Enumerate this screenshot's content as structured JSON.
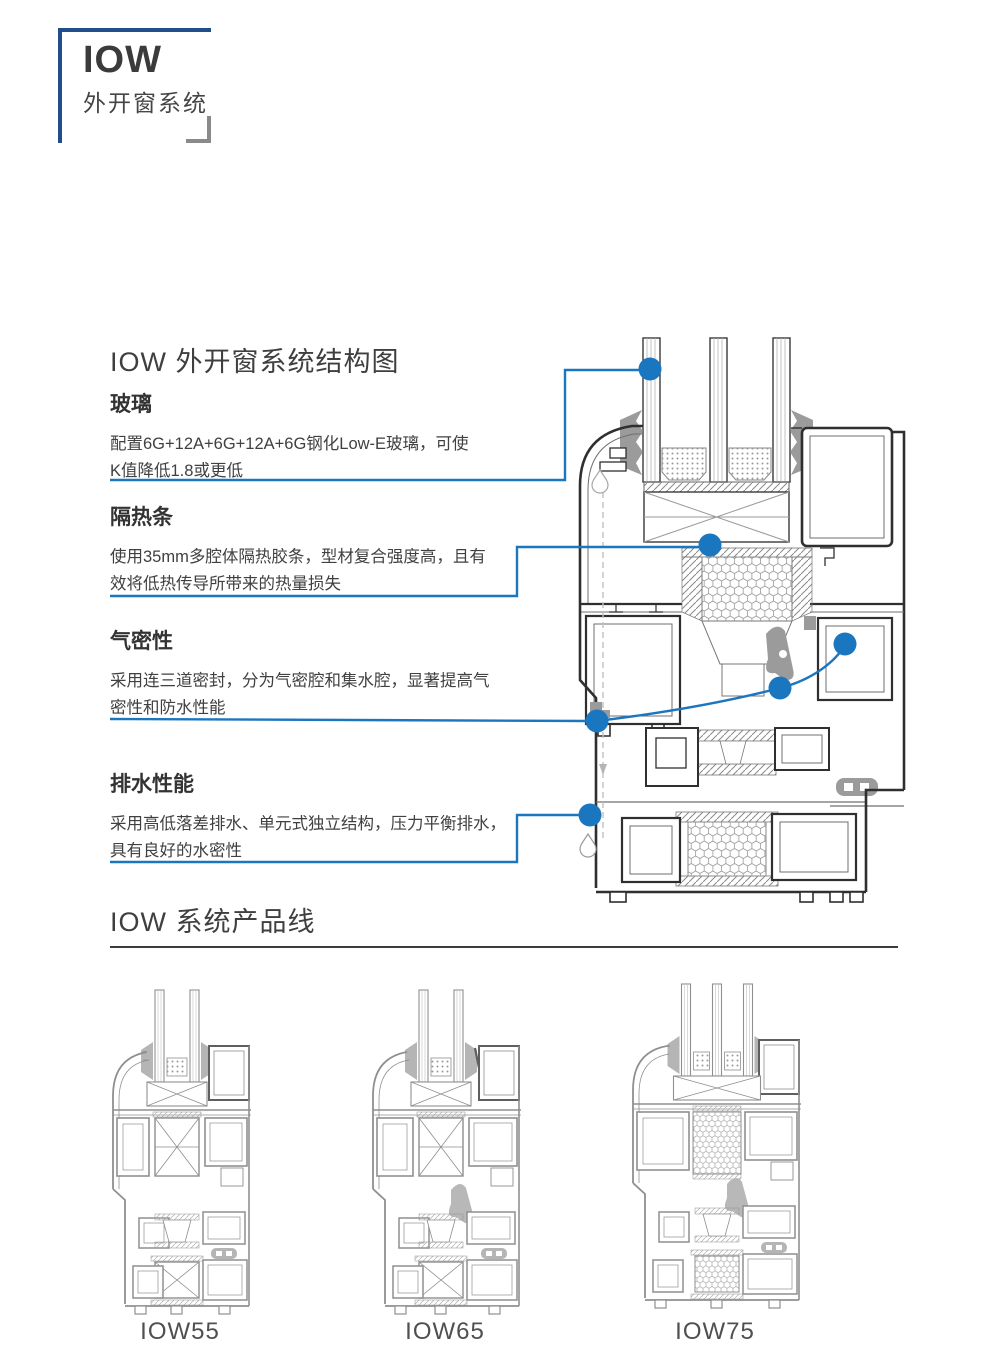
{
  "logo": {
    "name": "IOW",
    "subtitle": "外开窗系统"
  },
  "structure": {
    "heading": "IOW 外开窗系统结构图",
    "features": [
      {
        "title": "玻璃",
        "line1": "配置6G+12A+6G+12A+6G钢化Low-E玻璃，可使",
        "line2": "K值降低1.8或更低"
      },
      {
        "title": "隔热条",
        "line1": "使用35mm多腔体隔热胶条，型材复合强度高，且有",
        "line2": "效将低热传导所带来的热量损失"
      },
      {
        "title": "气密性",
        "line1": "采用连三道密封，分为气密腔和集水腔，显著提高气",
        "line2": "密性和防水性能"
      },
      {
        "title": "排水性能",
        "line1": "采用高低落差排水、单元式独立结构，压力平衡排水，",
        "line2": "具有良好的水密性"
      }
    ]
  },
  "products": {
    "heading": "IOW 系统产品线",
    "items": [
      {
        "label": "IOW55"
      },
      {
        "label": "IOW65"
      },
      {
        "label": "IOW75"
      }
    ]
  },
  "colors": {
    "accent_blue": "#1b76c0",
    "navy": "#1f4e8a",
    "heading_dark": "#3b3b3b",
    "diagram_dark": "#2f2f2f",
    "diagram_gray": "#8f8f8f"
  }
}
